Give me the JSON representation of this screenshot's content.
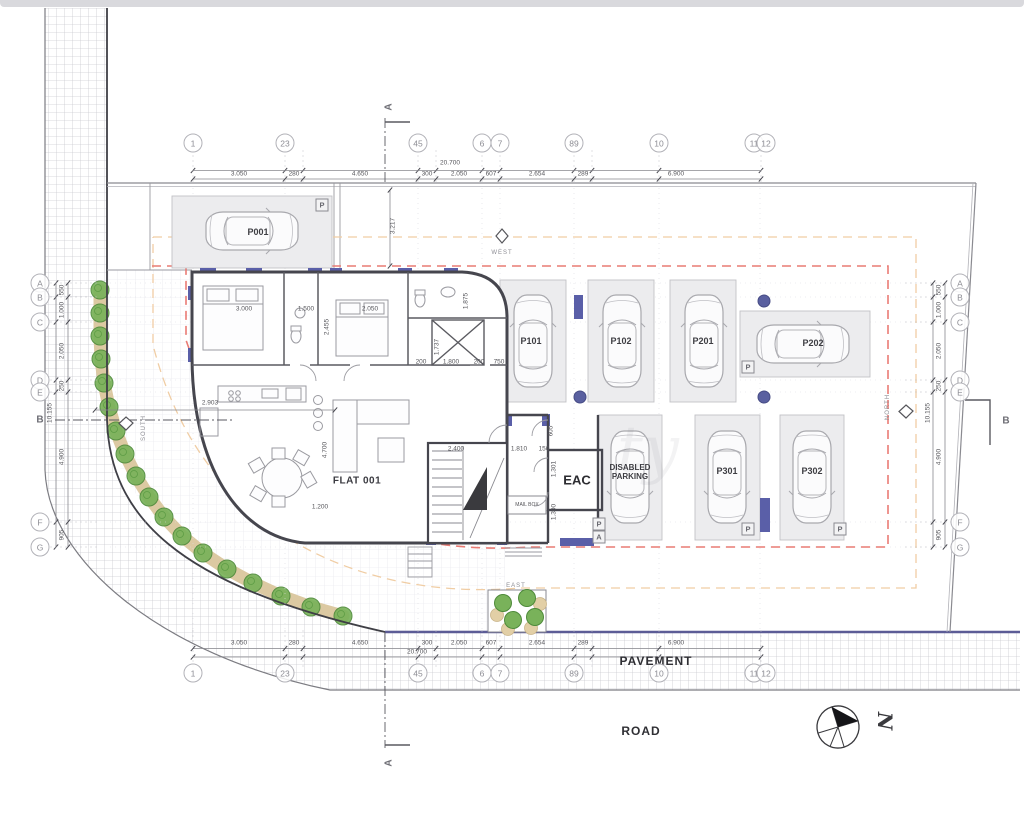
{
  "colors": {
    "setback_red": "#e97b74",
    "setback_orange": "#f0cda4",
    "wall_navy": "#5a5fa8",
    "tree_green": "#79b25a",
    "path_tan": "#dcc9a2",
    "boundary_navy": "#5c5c96"
  },
  "titles": {
    "flat": "FLAT 001",
    "eac": "EAC",
    "mailbox": "MAIL BOX",
    "pavement": "PAVEMENT",
    "road": "ROAD",
    "disabled": "DISABLED PARKING",
    "watermark": "ty"
  },
  "compass": {
    "letter": "N"
  },
  "sections": {
    "a": "A",
    "b": "B"
  },
  "orientation": [
    {
      "label": "WEST",
      "x": 502,
      "y": 253,
      "rot": 0
    },
    {
      "label": "NORTH",
      "x": 888,
      "y": 407,
      "rot": -90
    },
    {
      "label": "SOUTH",
      "x": 144,
      "y": 428,
      "rot": -90
    },
    {
      "label": "EAST",
      "x": 516,
      "y": 586,
      "rot": 0
    }
  ],
  "grid": {
    "cols": [
      {
        "label": "1",
        "x": 193
      },
      {
        "label": "23",
        "x": 285
      },
      {
        "label": "45",
        "x": 418
      },
      {
        "label": "6",
        "x": 482
      },
      {
        "label": "7",
        "x": 500
      },
      {
        "label": "89",
        "x": 574
      },
      {
        "label": "10",
        "x": 659
      },
      {
        "label": "1112",
        "x": 760
      }
    ],
    "col_bubble_y_top": 143,
    "col_bubble_y_bottom": 673,
    "rows": [
      {
        "label": "A",
        "y": 283
      },
      {
        "label": "B",
        "y": 297
      },
      {
        "label": "C",
        "y": 322
      },
      {
        "label": "D",
        "y": 380
      },
      {
        "label": "E",
        "y": 392
      },
      {
        "label": "F",
        "y": 522
      },
      {
        "label": "G",
        "y": 547
      }
    ],
    "row_bubble_x_left": 40,
    "row_bubble_x_right": 960
  },
  "dims": {
    "top_overall": "20.700",
    "bottom_overall": "20.700",
    "left_overall": "10.155",
    "right_overall": "10.155",
    "horizontal_segments": [
      {
        "t": "3.050",
        "x": 239
      },
      {
        "t": "280",
        "x": 294
      },
      {
        "t": "4.650",
        "x": 360
      },
      {
        "t": "300",
        "x": 427
      },
      {
        "t": "2.050",
        "x": 459
      },
      {
        "t": "607",
        "x": 491
      },
      {
        "t": "2.654",
        "x": 537
      },
      {
        "t": "289",
        "x": 583
      },
      {
        "t": "6.900",
        "x": 676
      }
    ],
    "vertical_segments": [
      {
        "t": "550",
        "y": 290
      },
      {
        "t": "1.000",
        "y": 310
      },
      {
        "t": "2.050",
        "y": 351
      },
      {
        "t": "250",
        "y": 386
      },
      {
        "t": "4.900",
        "y": 457
      },
      {
        "t": "905",
        "y": 535
      }
    ],
    "interior": [
      {
        "t": "3.000",
        "x": 244,
        "y": 309,
        "r": 0
      },
      {
        "t": "1.500",
        "x": 306,
        "y": 309,
        "r": 0
      },
      {
        "t": "2.050",
        "x": 370,
        "y": 309,
        "r": 0
      },
      {
        "t": "2.455",
        "x": 327,
        "y": 327,
        "r": -90
      },
      {
        "t": "1.875",
        "x": 466,
        "y": 301,
        "r": -90
      },
      {
        "t": "1.737",
        "x": 437,
        "y": 347,
        "r": -90
      },
      {
        "t": "200",
        "x": 421,
        "y": 362,
        "r": 0
      },
      {
        "t": "1.800",
        "x": 451,
        "y": 362,
        "r": 0
      },
      {
        "t": "200",
        "x": 479,
        "y": 362,
        "r": 0
      },
      {
        "t": "750",
        "x": 499,
        "y": 362,
        "r": 0
      },
      {
        "t": "2.903",
        "x": 210,
        "y": 403,
        "r": 0
      },
      {
        "t": "3.217",
        "x": 393,
        "y": 226,
        "r": -90
      },
      {
        "t": "4.700",
        "x": 325,
        "y": 450,
        "r": -90
      },
      {
        "t": "2.400",
        "x": 456,
        "y": 449,
        "r": 0
      },
      {
        "t": "1.200",
        "x": 320,
        "y": 507,
        "r": 0
      },
      {
        "t": "1.810",
        "x": 519,
        "y": 449,
        "r": 0
      },
      {
        "t": "150",
        "x": 544,
        "y": 449,
        "r": 0
      },
      {
        "t": "605",
        "x": 551,
        "y": 431,
        "r": -90
      },
      {
        "t": "1.301",
        "x": 554,
        "y": 469,
        "r": -90
      },
      {
        "t": "1.300",
        "x": 554,
        "y": 512,
        "r": -90
      }
    ]
  },
  "parking": {
    "stall_labels": [
      {
        "label": "P001",
        "x": 258,
        "y": 232
      },
      {
        "label": "P101",
        "x": 531,
        "y": 341
      },
      {
        "label": "P102",
        "x": 621,
        "y": 341
      },
      {
        "label": "P201",
        "x": 703,
        "y": 341
      },
      {
        "label": "P202",
        "x": 813,
        "y": 343
      },
      {
        "label": "P301",
        "x": 727,
        "y": 471
      },
      {
        "label": "P302",
        "x": 812,
        "y": 471
      }
    ],
    "disabled": {
      "x": 630,
      "y": 472
    },
    "p_markers": [
      {
        "t": "P",
        "x": 322,
        "y": 205
      },
      {
        "t": "P",
        "x": 748,
        "y": 367
      },
      {
        "t": "P",
        "x": 599,
        "y": 524
      },
      {
        "t": "A",
        "x": 599,
        "y": 537
      },
      {
        "t": "P",
        "x": 748,
        "y": 529
      },
      {
        "t": "P",
        "x": 840,
        "y": 529
      }
    ]
  }
}
